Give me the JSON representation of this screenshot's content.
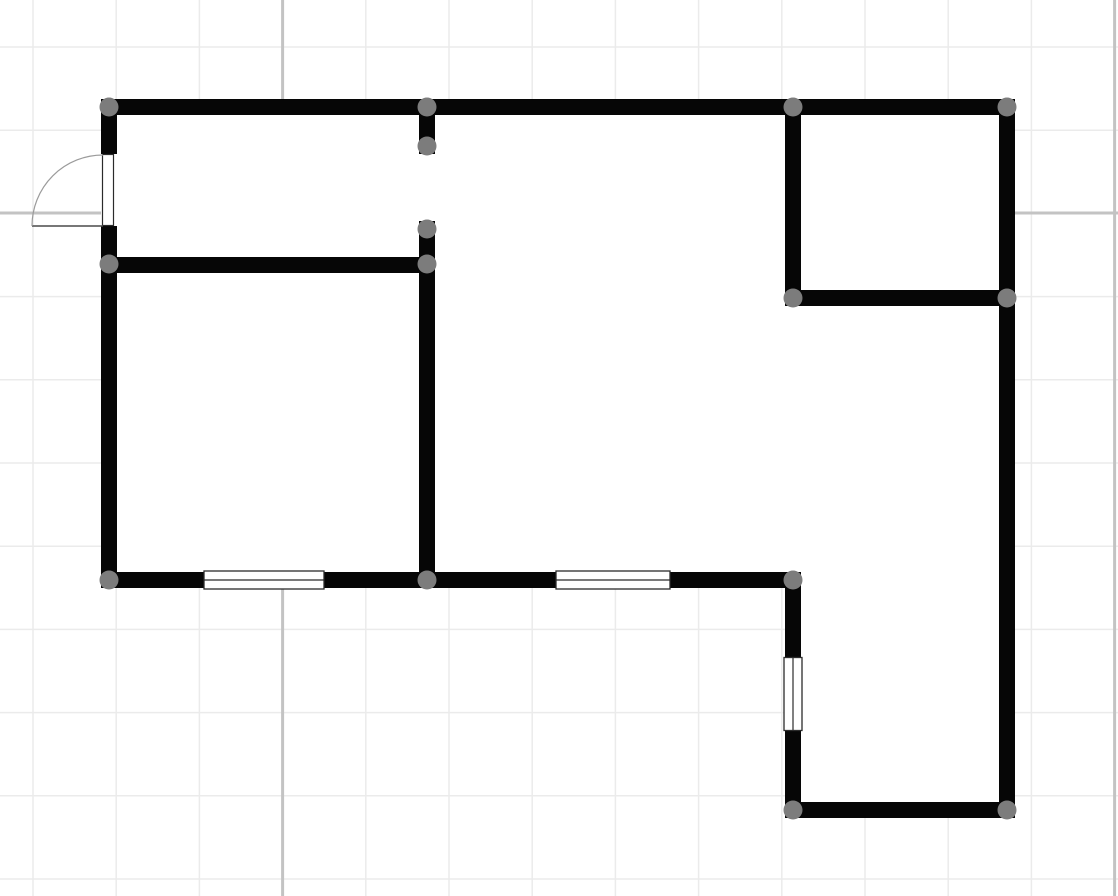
{
  "canvas": {
    "width": 1118,
    "height": 896,
    "background": "#ffffff"
  },
  "grid": {
    "minor": {
      "spacing": 83.2,
      "offset_x": 33,
      "offset_y": 47,
      "color": "#ebebeb",
      "width": 1.5
    },
    "major": {
      "color": "#c3c3c3",
      "width": 3,
      "vertical_x": [
        282.6,
        1114.6
      ],
      "horizontal_y": [
        213
      ]
    }
  },
  "floorplan": {
    "wall": {
      "color": "#060606",
      "thickness": 16
    },
    "node": {
      "color": "#7c7c7c",
      "radius": 9.5
    },
    "floor_fill": "#ffffff",
    "floor_outline": [
      [
        101,
        99
      ],
      [
        1015,
        99
      ],
      [
        1015,
        818
      ],
      [
        785,
        818
      ],
      [
        785,
        588
      ],
      [
        101,
        588
      ]
    ],
    "walls": [
      {
        "id": "top-exterior",
        "x": 101,
        "y": 99,
        "w": 914,
        "h": 16
      },
      {
        "id": "left-exterior-above-door",
        "x": 101,
        "y": 99,
        "w": 16,
        "h": 55
      },
      {
        "id": "left-exterior-below-door",
        "x": 101,
        "y": 226,
        "w": 16,
        "h": 362
      },
      {
        "id": "interior-room-top",
        "x": 101,
        "y": 257,
        "w": 334,
        "h": 16
      },
      {
        "id": "doorway-stub",
        "x": 419,
        "y": 99,
        "w": 16,
        "h": 55
      },
      {
        "id": "interior-vertical",
        "x": 419,
        "y": 221,
        "w": 16,
        "h": 367
      },
      {
        "id": "closet-left",
        "x": 785,
        "y": 99,
        "w": 16,
        "h": 207
      },
      {
        "id": "closet-bottom",
        "x": 785,
        "y": 290,
        "w": 230,
        "h": 16
      },
      {
        "id": "right-exterior",
        "x": 999,
        "y": 99,
        "w": 16,
        "h": 719
      },
      {
        "id": "bottom-exterior-main",
        "x": 101,
        "y": 572,
        "w": 700,
        "h": 16
      },
      {
        "id": "wing-left",
        "x": 785,
        "y": 572,
        "w": 16,
        "h": 246
      },
      {
        "id": "bottom-exterior-wing",
        "x": 785,
        "y": 802,
        "w": 230,
        "h": 16
      }
    ],
    "nodes": [
      {
        "x": 109,
        "y": 107
      },
      {
        "x": 427,
        "y": 107
      },
      {
        "x": 793,
        "y": 107
      },
      {
        "x": 1007,
        "y": 107
      },
      {
        "x": 427,
        "y": 146
      },
      {
        "x": 427,
        "y": 229
      },
      {
        "x": 109,
        "y": 264
      },
      {
        "x": 427,
        "y": 264
      },
      {
        "x": 793,
        "y": 298
      },
      {
        "x": 1007,
        "y": 298
      },
      {
        "x": 109,
        "y": 580
      },
      {
        "x": 427,
        "y": 580
      },
      {
        "x": 793,
        "y": 580
      },
      {
        "x": 793,
        "y": 810
      },
      {
        "x": 1007,
        "y": 810
      }
    ],
    "window_style": {
      "fill": "#ffffff",
      "frame_color": "#2b2b2b",
      "frame_width": 1.3,
      "midline_width": 1.2
    },
    "windows": [
      {
        "orientation": "horizontal",
        "cx": 264,
        "cy": 580,
        "length": 120,
        "frame": 18
      },
      {
        "orientation": "horizontal",
        "cx": 613,
        "cy": 580,
        "length": 114,
        "frame": 18
      },
      {
        "orientation": "vertical",
        "cx": 793,
        "cy": 694,
        "length": 73,
        "frame": 18
      }
    ],
    "door": {
      "opening": {
        "x": 101,
        "y": 154,
        "w": 16,
        "h": 72
      },
      "frame": {
        "x": 102.5,
        "y": 154.5,
        "w": 11,
        "h": 71
      },
      "hinge": {
        "x": 103,
        "y": 226
      },
      "leaf_end": {
        "x": 32,
        "y": 226
      },
      "arc_start": {
        "x": 103,
        "y": 155
      },
      "radius": 71,
      "frame_color": "#2b2b2b",
      "leaf_color": "#4a4a4a",
      "arc_color": "#9b9b9b"
    }
  }
}
